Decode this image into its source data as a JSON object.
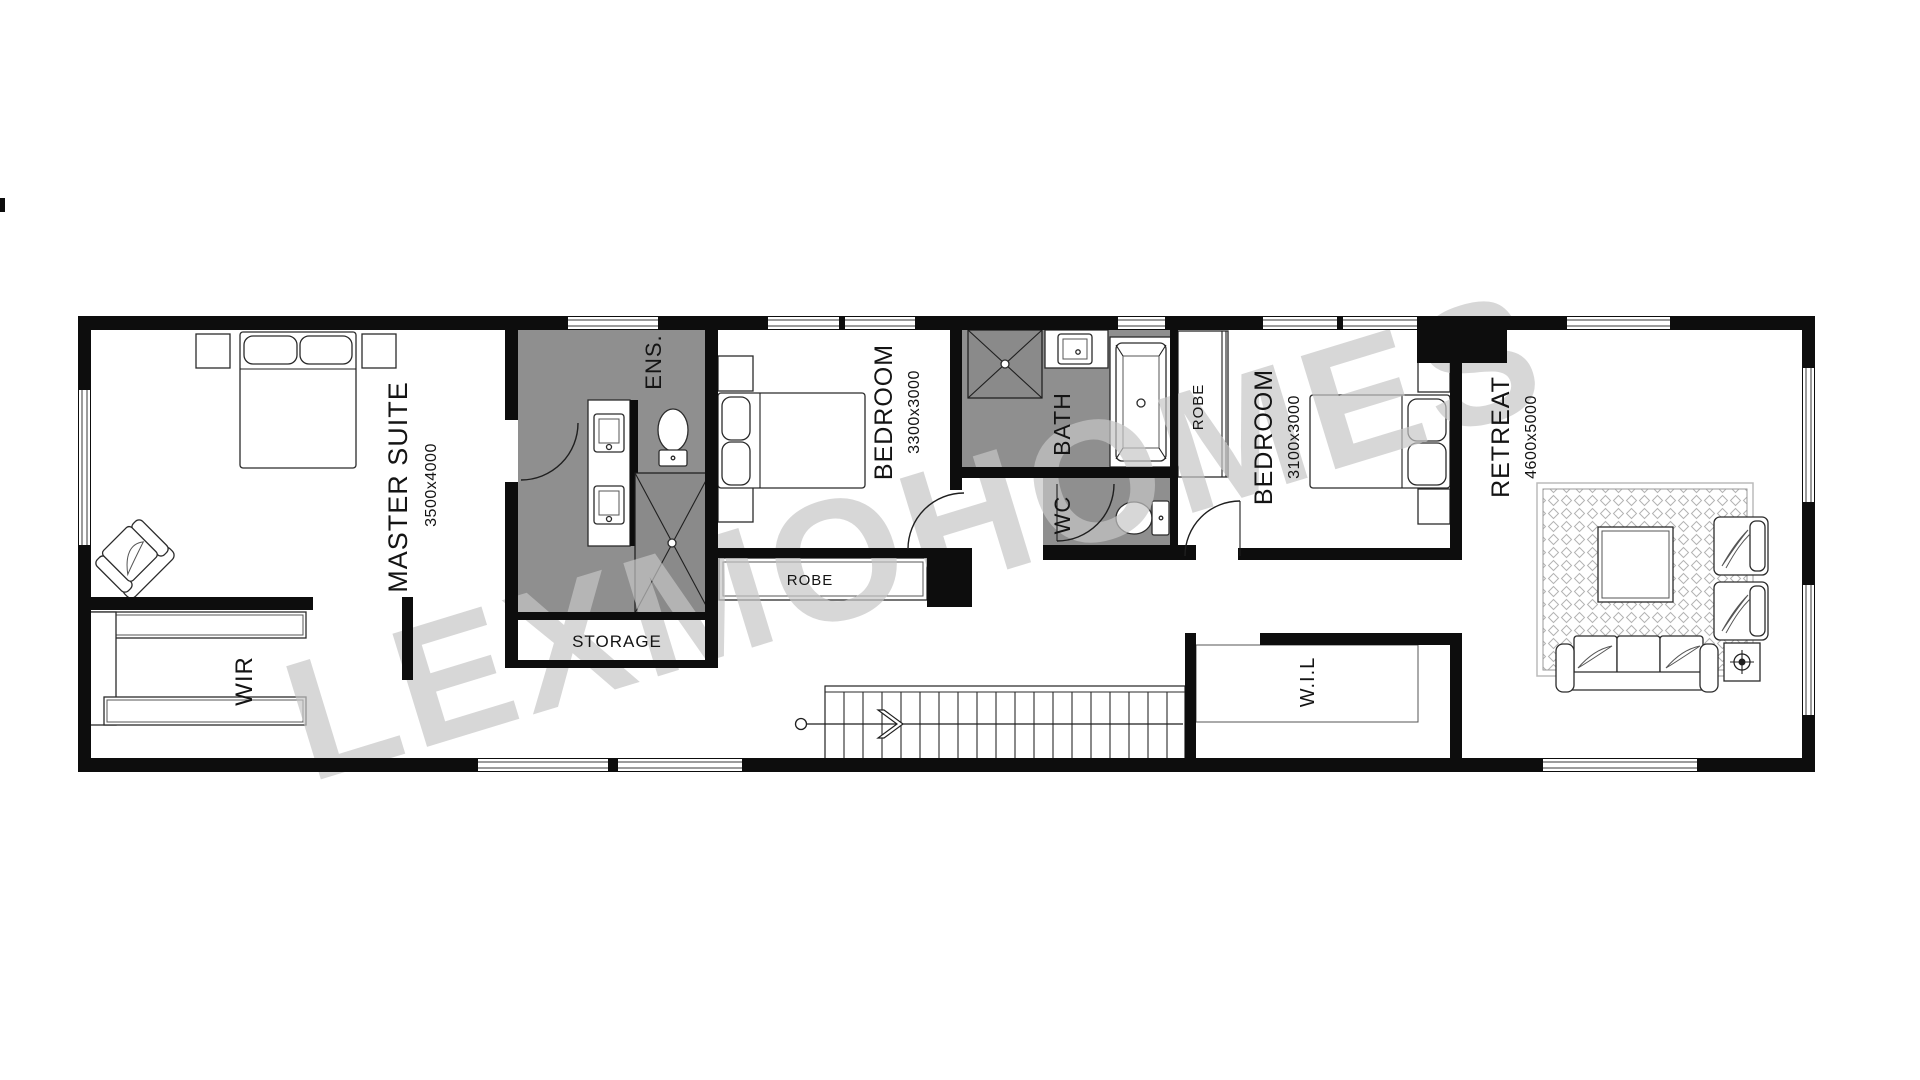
{
  "watermark": {
    "text": "LEXMOHOMES"
  },
  "rooms": {
    "master_suite": {
      "name": "MASTER SUITE",
      "dimensions": "3500x4000"
    },
    "wir": {
      "name": "WIR"
    },
    "ens": {
      "name": "ENS."
    },
    "storage": {
      "name": "STORAGE"
    },
    "bedroom_1": {
      "name": "BEDROOM",
      "dimensions": "3300x3000"
    },
    "robe_1": {
      "name": "ROBE"
    },
    "bath": {
      "name": "BATH"
    },
    "wc": {
      "name": "WC"
    },
    "robe_2": {
      "name": "ROBE"
    },
    "bedroom_2": {
      "name": "BEDROOM",
      "dimensions": "3100x3000"
    },
    "wil": {
      "name": "W.I.L"
    },
    "retreat": {
      "name": "RETREAT",
      "dimensions": "4600x5000"
    }
  },
  "colors": {
    "wall": "#0d0d0d",
    "wet_area": "#8f8f8f",
    "shower": "#8a8a8a",
    "watermark": "#c6c6c6",
    "background": "#ffffff"
  }
}
